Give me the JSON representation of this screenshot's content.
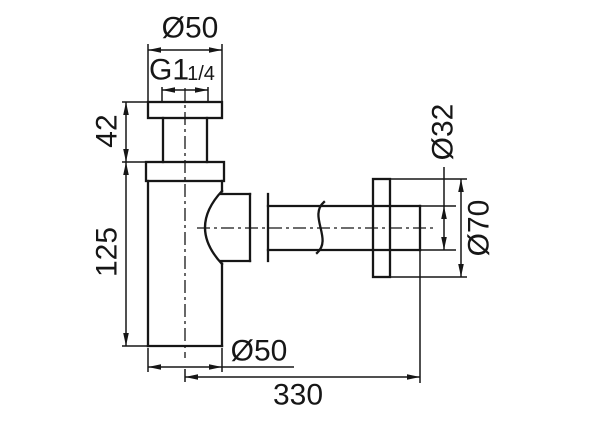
{
  "drawing": {
    "title": "bottle trap technical drawing",
    "background_color": "#ffffff",
    "line_color": "#161616",
    "dimensions": {
      "top_diameter": "Ø50",
      "thread": "G1",
      "thread_fraction": "1/4",
      "upper_height": "42",
      "body_height": "125",
      "pipe_diameter": "Ø32",
      "flange_diameter": "Ø70",
      "body_diameter": "Ø50",
      "overall_length": "330"
    }
  }
}
